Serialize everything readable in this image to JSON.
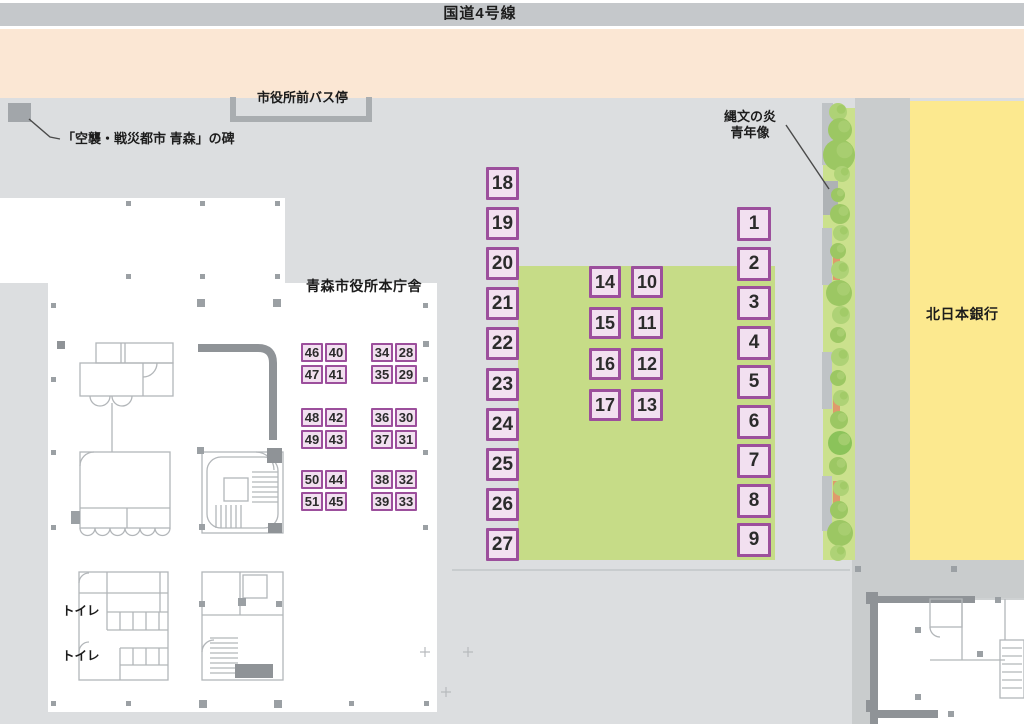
{
  "labels": {
    "road": "国道4号線",
    "bus_stop": "市役所前バス停",
    "monument": "「空襲・戦災都市 青森」の碑",
    "statue_line1": "縄文の炎",
    "statue_line2": "青年像",
    "city_hall": "青森市役所本庁舎",
    "bank": "北日本銀行",
    "toilet_1": "トイレ",
    "toilet_2": "トイレ"
  },
  "stalls": {
    "column_west": [
      "18",
      "19",
      "20",
      "21",
      "22",
      "23",
      "24",
      "25",
      "26",
      "27"
    ],
    "column_east": [
      "1",
      "2",
      "3",
      "4",
      "5",
      "6",
      "7",
      "8",
      "9"
    ],
    "center_rows": [
      [
        "14",
        "10"
      ],
      [
        "15",
        "11"
      ],
      [
        "16",
        "12"
      ],
      [
        "17",
        "13"
      ]
    ],
    "hall_pairs_west": [
      [
        "46",
        "40"
      ],
      [
        "47",
        "41"
      ],
      [
        "48",
        "42"
      ],
      [
        "49",
        "43"
      ],
      [
        "50",
        "44"
      ],
      [
        "51",
        "45"
      ]
    ],
    "hall_pairs_east": [
      [
        "34",
        "28"
      ],
      [
        "35",
        "29"
      ],
      [
        "36",
        "30"
      ],
      [
        "37",
        "31"
      ],
      [
        "38",
        "32"
      ],
      [
        "39",
        "33"
      ]
    ]
  },
  "colors": {
    "road_gray": "#c5c8cb",
    "peach": "#fbe7d4",
    "plaza": "#dcdee0",
    "curb": "#c9cccd",
    "lawn": "#c6dc87",
    "strip": "#cbe18d",
    "bank": "#fce98f",
    "stall_fill": "#f2e0f0",
    "stall_border": "#9c4f9c",
    "bench": "#df9a6c",
    "ink": "#1f1f1f"
  }
}
